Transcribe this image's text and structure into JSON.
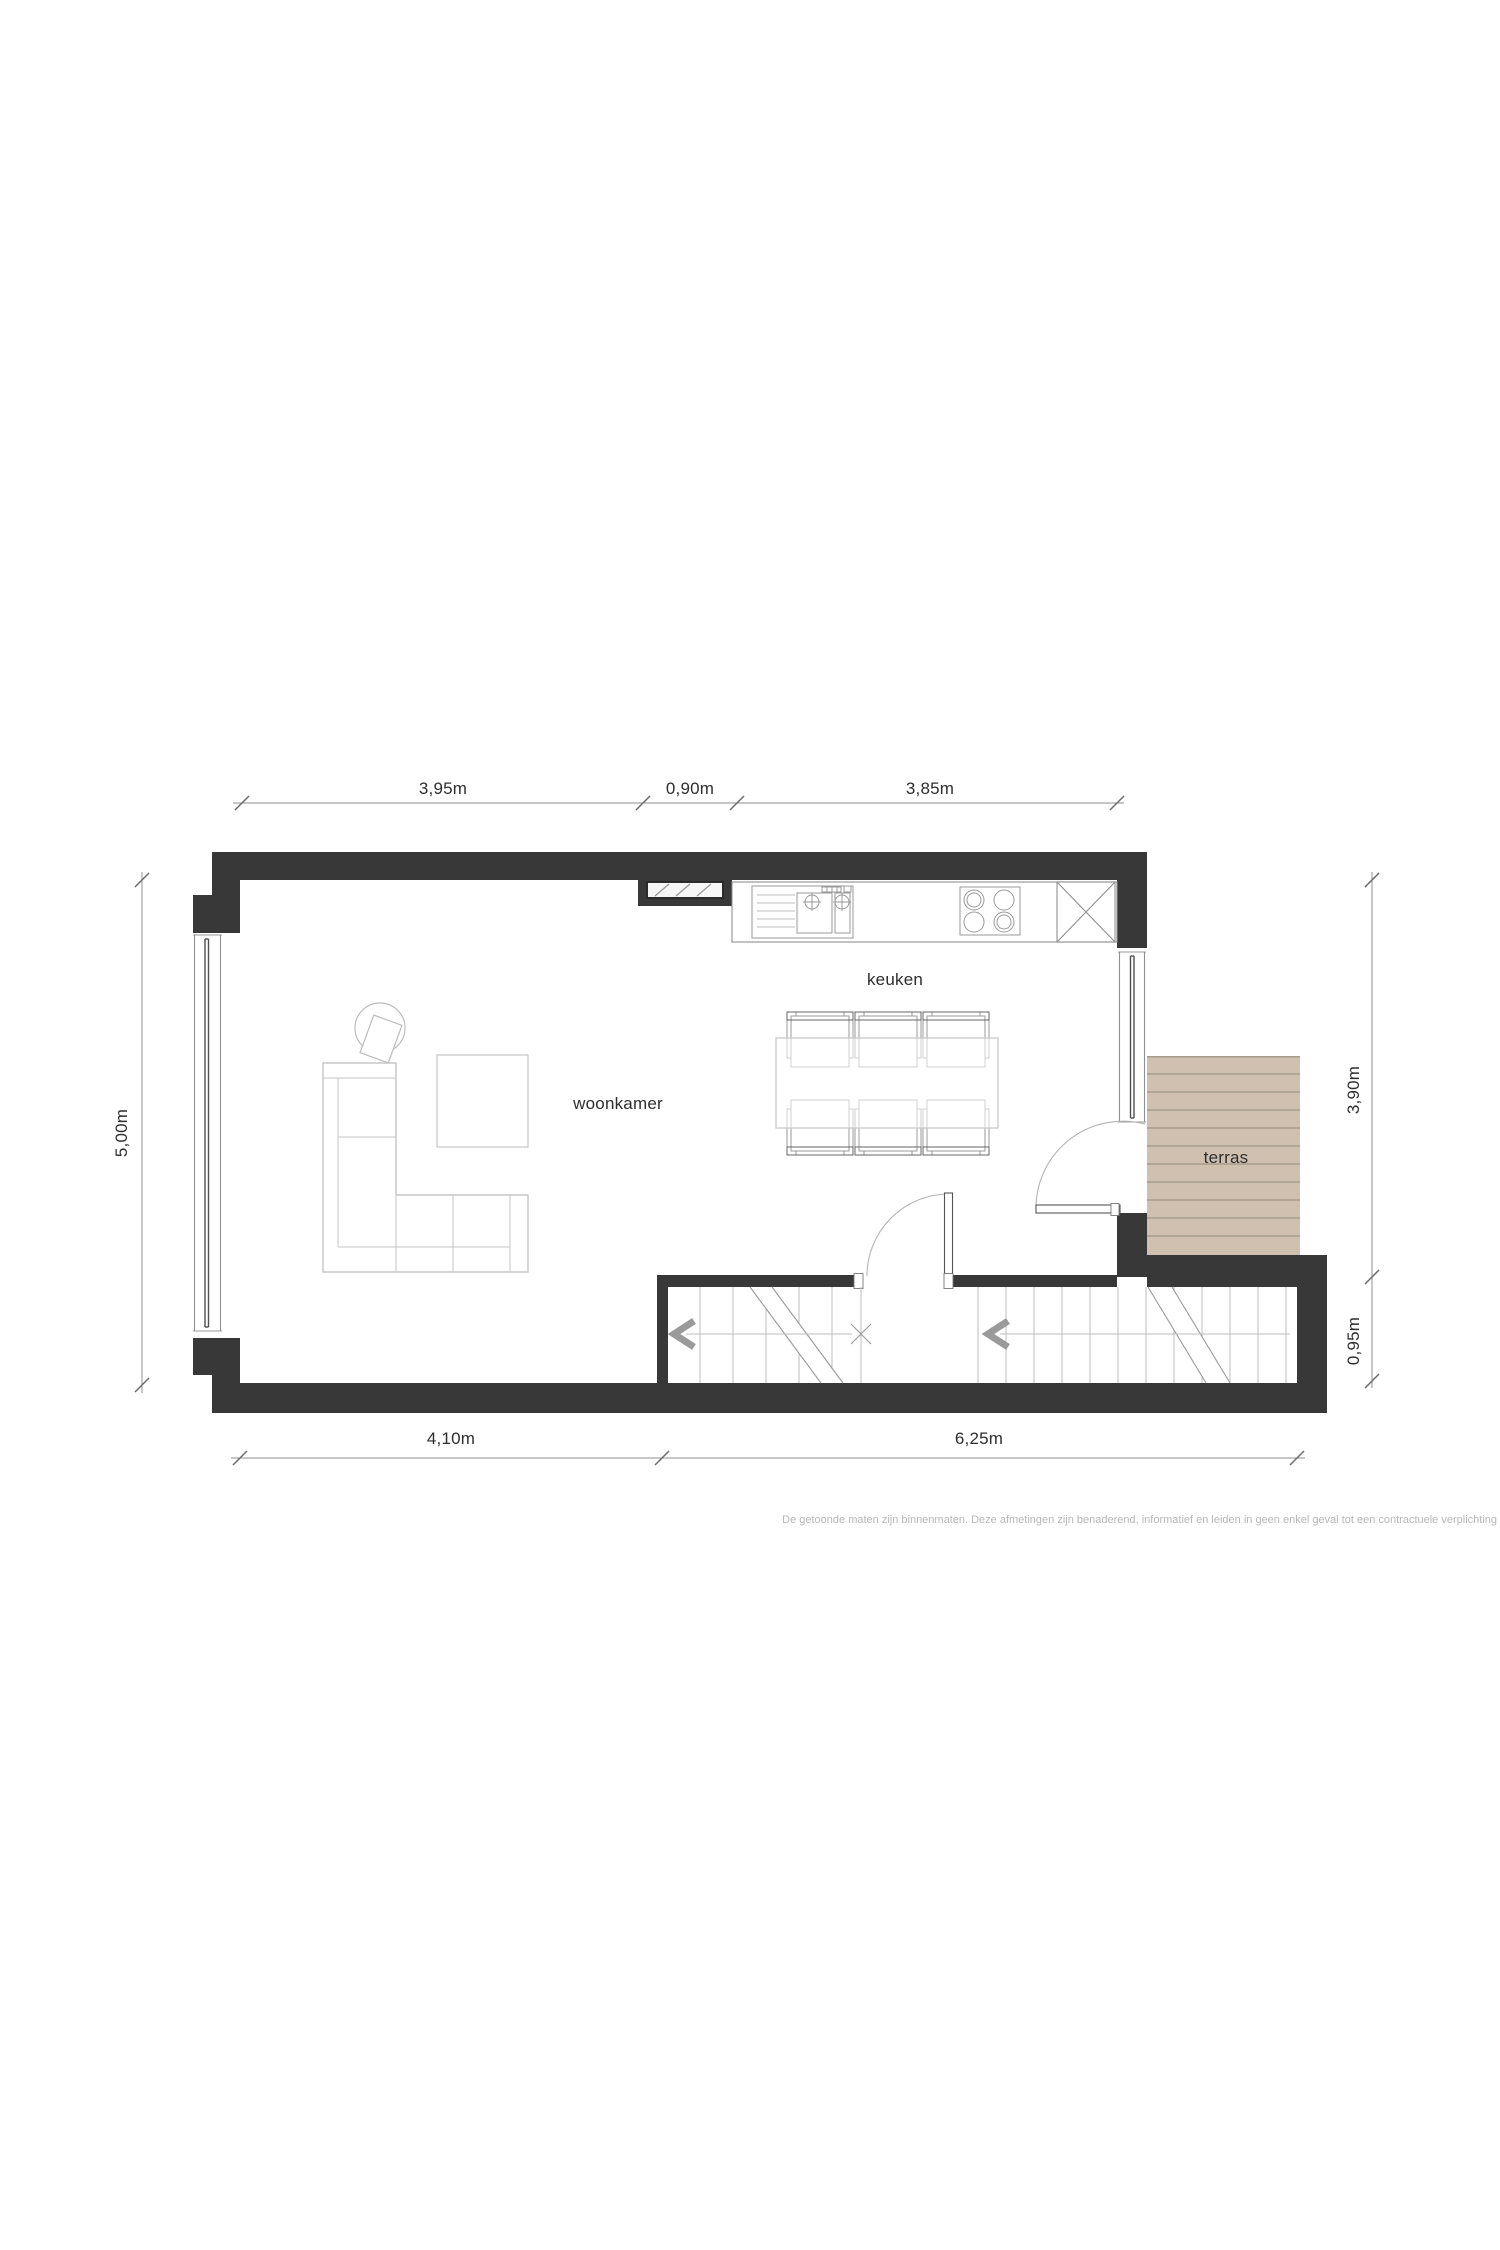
{
  "rooms": {
    "living": {
      "label": "woonkamer"
    },
    "kitchen": {
      "label": "keuken"
    },
    "terrace": {
      "label": "terras"
    }
  },
  "dimensions": {
    "top": [
      "3,95m",
      "0,90m",
      "3,85m"
    ],
    "bottom": [
      "4,10m",
      "6,25m"
    ],
    "left": [
      "5,00m"
    ],
    "right": [
      "3,90m",
      "0,95m"
    ]
  },
  "disclaimer": "De getoonde maten zijn binnenmaten. Deze afmetingen zijn benaderend, informatief en leiden in geen enkel geval tot een contractuele verplichting",
  "colors": {
    "wall": "#383838",
    "terrace_fill": "#cfc0b0",
    "terrace_line": "#a79c8c",
    "line_light": "#bcbcbc",
    "line_mid": "#9a9a9a",
    "dim_line": "#8f8f8f",
    "label_text": "#2e2e2e",
    "disclaimer_text": "#b7b7b7",
    "hatch_fill": "#f6f6f6"
  }
}
